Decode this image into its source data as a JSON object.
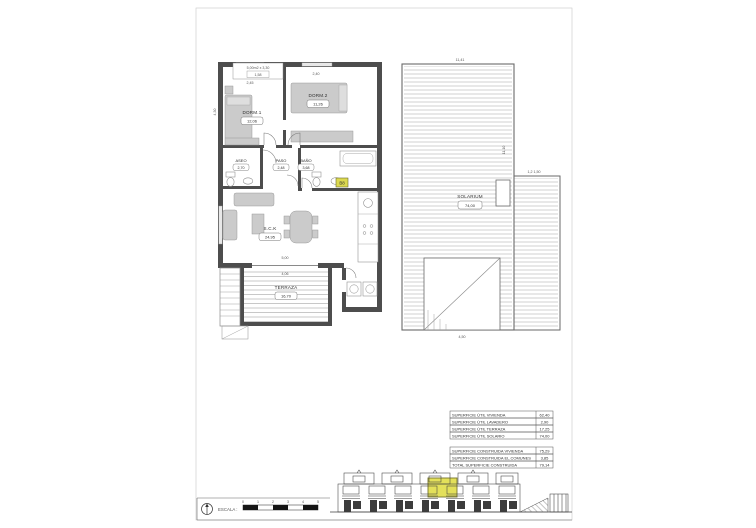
{
  "sheet": {
    "bg": "#ffffff",
    "wall_color": "#4d4d4d",
    "furniture_fill": "#cbcbcb",
    "hatch_color": "#a3a3a3",
    "highlight_color": "#e3e05a"
  },
  "floor_plan": {
    "note_line1": "5,00m2 x 3,30",
    "note_line2": "1,58",
    "unit_badge": "B8",
    "rooms": [
      {
        "name": "DORM.1",
        "area": "12,06"
      },
      {
        "name": "DORM.2",
        "area": "11,26"
      },
      {
        "name": "ASEO",
        "area": "2,70"
      },
      {
        "name": "PASO",
        "area": "2,48"
      },
      {
        "name": "BAÑO",
        "area": "3,68"
      },
      {
        "name": "S.C.K",
        "area": "24,95"
      },
      {
        "name": "TERRAZA",
        "area": "16,70"
      }
    ],
    "dims": {
      "dorm1_width": "2,45",
      "dorm2_width": "2,40",
      "left_height": "4,30",
      "terrace_out": "5,00",
      "terrace_in": "4,06"
    }
  },
  "solarium_plan": {
    "room": {
      "name": "SOLARIUM",
      "area": "74,00"
    },
    "dims": {
      "top_width": "11,41",
      "right_step": "1,2  1,50",
      "right_height": "11,10",
      "stair_width": "4,50"
    }
  },
  "surface_tables": {
    "utile": {
      "rows": [
        {
          "label": "SUPERFICIE ÚTIL VIVIENDA",
          "value": "62,40"
        },
        {
          "label": "SUPERFICIE ÚTIL LAVADERO",
          "value": "2,90"
        },
        {
          "label": "SUPERFICIE ÚTIL TERRAZA",
          "value": "17,25"
        },
        {
          "label": "SUPERFICIE ÚTIL SOLARIO",
          "value": "74,00"
        }
      ]
    },
    "construida": {
      "rows": [
        {
          "label": "SUPERFICIE CONSTRUIDA VIVIENDA",
          "value": "75,29"
        },
        {
          "label": "SUPERFICIE CONSTRUIDA EL.COMUNES",
          "value": "3,85"
        },
        {
          "label": "TOTAL SUPERFICIE CONSTRUIDA",
          "value": "79,14"
        }
      ]
    }
  },
  "title_block": {
    "scale_label": "ESCALA :",
    "scale_ticks": [
      "0",
      "1",
      "2",
      "3",
      "4",
      "5"
    ]
  }
}
